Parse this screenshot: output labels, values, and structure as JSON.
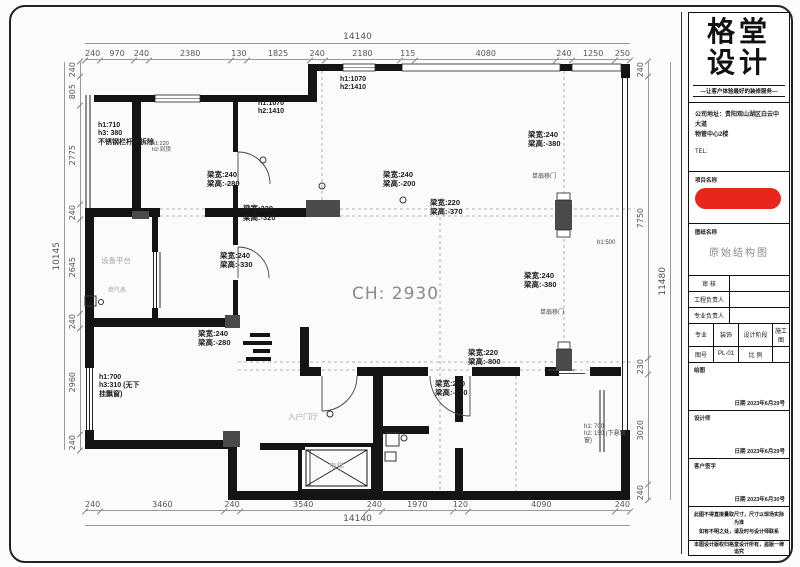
{
  "dims": {
    "top_total": "14140",
    "top": [
      "240",
      "970",
      "240",
      "2380",
      "130",
      "1825",
      "240",
      "2180",
      "115",
      "4080",
      "240",
      "1250",
      "250"
    ],
    "bottom": [
      "240",
      "3460",
      "240",
      "3540",
      "240",
      "1970",
      "120",
      "4090",
      "240"
    ],
    "bottom_total": "14140",
    "left": [
      "240",
      "805",
      "2775",
      "240",
      "2645",
      "240",
      "2960",
      "240"
    ],
    "left_total": "10145",
    "right": [
      "240",
      "7750",
      "230",
      "3020",
      "240"
    ],
    "right_total": "11480"
  },
  "beams": [
    {
      "w": "梁宽:240",
      "h": "梁高:-280"
    },
    {
      "w": "梁宽:240",
      "h": "梁高:-200"
    },
    {
      "w": "梁宽:220",
      "h": "梁高:-320"
    },
    {
      "w": "梁宽:220",
      "h": "梁高:-370"
    },
    {
      "w": "梁宽:240",
      "h": "梁高:-380"
    },
    {
      "w": "梁宽:240",
      "h": "梁高:-380"
    },
    {
      "w": "梁宽:240",
      "h": "梁高:-330"
    },
    {
      "w": "梁宽:240",
      "h": "梁高:-280"
    },
    {
      "w": "梁宽:220",
      "h": "梁高:-800"
    },
    {
      "w": "梁宽:240",
      "h": "梁高:-180"
    }
  ],
  "heights": {
    "balcony": {
      "l1": "h1:710",
      "l2": "h3: 380",
      "l3": "不锈钢栏杆可拆除",
      "s1": "h1:220",
      "s2": "h2:到顶"
    },
    "win1": {
      "l1": "h1:1070",
      "l2": "h2:1410"
    },
    "win2": {
      "l1": "h1:1070",
      "l2": "h2:1410"
    },
    "win3": "h1:500",
    "win4": {
      "l1": "h1: 700",
      "l2": "h2: 150 (下悬飘",
      "l3": "窗)"
    },
    "win5": {
      "l1": "h1:700",
      "l2": "h3:310 (无下",
      "l3": "挂飘窗)"
    }
  },
  "rooms": {
    "ceiling": "CH: 2930",
    "equip": "设备平台",
    "gas": "燃气表",
    "foyer": "入户门厅",
    "lift": "电梯",
    "slide_door_top": "单扇移门",
    "slide_door_mid": "单扇移门"
  },
  "title_block": {
    "logo1": "格堂",
    "logo2": "设计",
    "slogan": "—让客户体验最好的装修服务—",
    "addr1": "公司地址：贵阳观山湖区白云中大道",
    "addr2": "物管中心2楼",
    "tel": "TEL:",
    "project_label": "项目名称",
    "sheet_label": "图纸名称",
    "sheet_name": "原始结构图",
    "review_label": "审 核",
    "pm_label": "工程负责人",
    "lead_label": "专业负责人",
    "major_label": "专业",
    "major_value": "装饰",
    "stage_label": "设计阶段",
    "stage_value": "施工图",
    "no_label": "图号",
    "no_value": "PL-01",
    "scale_label": "比 例",
    "scale_value": "",
    "draft_label": "绘图",
    "draft_date": "日期 2023年6月29号",
    "designer_label": "设计师",
    "designer_date": "日期 2023年6月29号",
    "client_label": "客户签字",
    "client_date": "日期 2023年6月30号",
    "note1": "此图不得直接量取尺寸，尺寸以现场实际为准",
    "note2": "如有不明之处，请及时与设计师联系",
    "copyright": "本图设计版权归格堂设计所有，盗版一律追究"
  }
}
